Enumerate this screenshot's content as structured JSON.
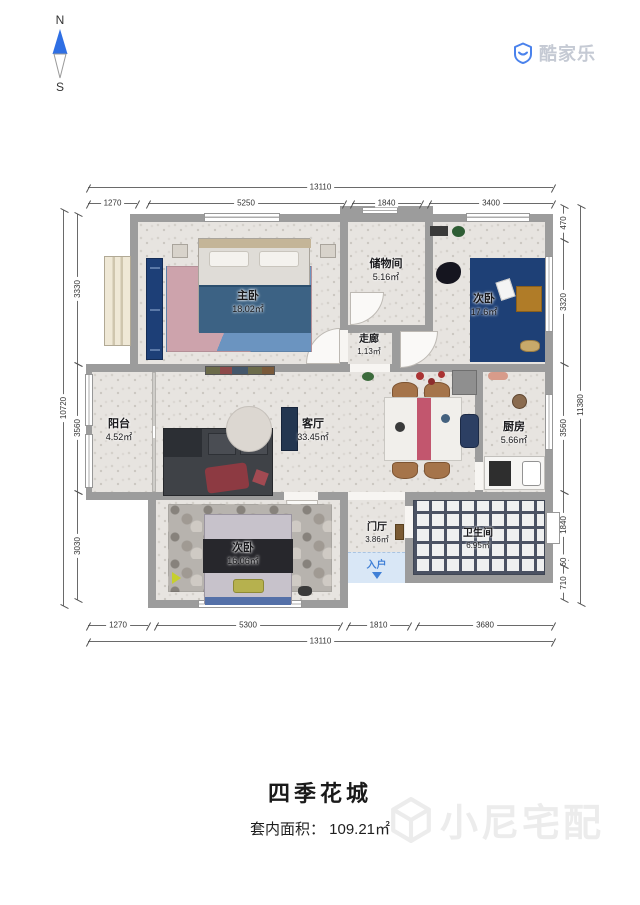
{
  "compass": {
    "north": "N",
    "south": "S"
  },
  "logo": {
    "brand": "酷家乐"
  },
  "plan": {
    "rooms": [
      {
        "name": "主卧",
        "area": "18.02㎡"
      },
      {
        "name": "储物间",
        "area": "5.16㎡"
      },
      {
        "name": "走廊",
        "area": "1.13㎡"
      },
      {
        "name": "次卧",
        "area": "17.6㎡"
      },
      {
        "name": "阳台",
        "area": "4.52㎡"
      },
      {
        "name": "客厅",
        "area": "33.45㎡"
      },
      {
        "name": "厨房",
        "area": "5.66㎡"
      },
      {
        "name": "次卧",
        "area": "16.06㎡"
      },
      {
        "name": "门厅",
        "area": "3.86㎡"
      },
      {
        "name": "卫生间",
        "area": "6.95㎡"
      }
    ],
    "entrance_label": "入户",
    "dimensions": {
      "top": {
        "total": "13110",
        "segments": [
          "1270",
          "5250",
          "1840",
          "3400"
        ]
      },
      "bottom": {
        "total": "13110",
        "segments": [
          "1270",
          "5300",
          "1810",
          "3680"
        ]
      },
      "left": {
        "total": "10720",
        "segments": [
          "3330",
          "3560",
          "3030"
        ]
      },
      "right": {
        "total": "11380",
        "segments": [
          "470",
          "3320",
          "3560",
          "1840",
          "60",
          "710"
        ]
      }
    }
  },
  "footer": {
    "title": "四季花城",
    "area_label": "套内面积：",
    "area_value": "109.21㎡",
    "watermark": "小尼宅配"
  },
  "colors": {
    "brand_blue": "#4a82ec",
    "compass_blue": "#2f6fe4",
    "wall_gray": "#9c9c9c",
    "bedroom_navy": "#1e4076",
    "entrance_blue": "#3f7fd6",
    "watermark_gray": "#ececec"
  }
}
